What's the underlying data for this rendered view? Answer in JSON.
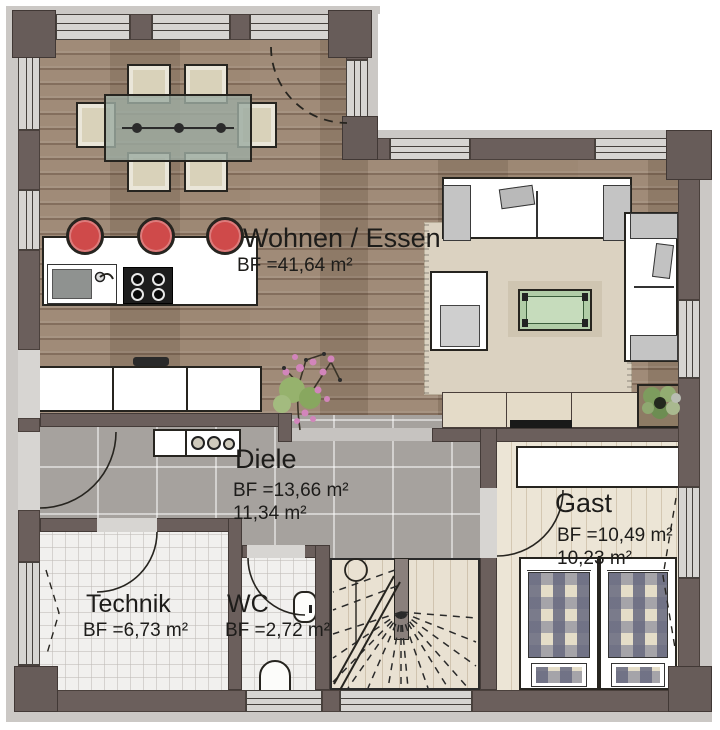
{
  "plan": {
    "rooms": {
      "wohnen_essen": {
        "name": "Wohnen / Essen",
        "bf": "BF =41,64 m²"
      },
      "diele": {
        "name": "Diele",
        "bf": "BF =13,66 m²",
        "wf": "11,34 m²"
      },
      "gast": {
        "name": "Gast",
        "bf": "BF =10,49 m²",
        "wf": "10,23 m²"
      },
      "technik": {
        "name": "Technik",
        "bf": "BF =6,73 m²"
      },
      "wc": {
        "name": "WC",
        "bf": "BF =2,72 m²"
      }
    },
    "colors": {
      "wall": "#6b5f5c",
      "window_band": "#d7d5d2",
      "wood_floor": "#9a8470",
      "hall_tile": "#a6a29e",
      "white_tile": "#f1f0ee",
      "guest_floor": "#ece5d6",
      "stool_accent": "#cf4a4a",
      "coffee_table": "#b1cda7",
      "text": "#1d1c1a"
    }
  }
}
